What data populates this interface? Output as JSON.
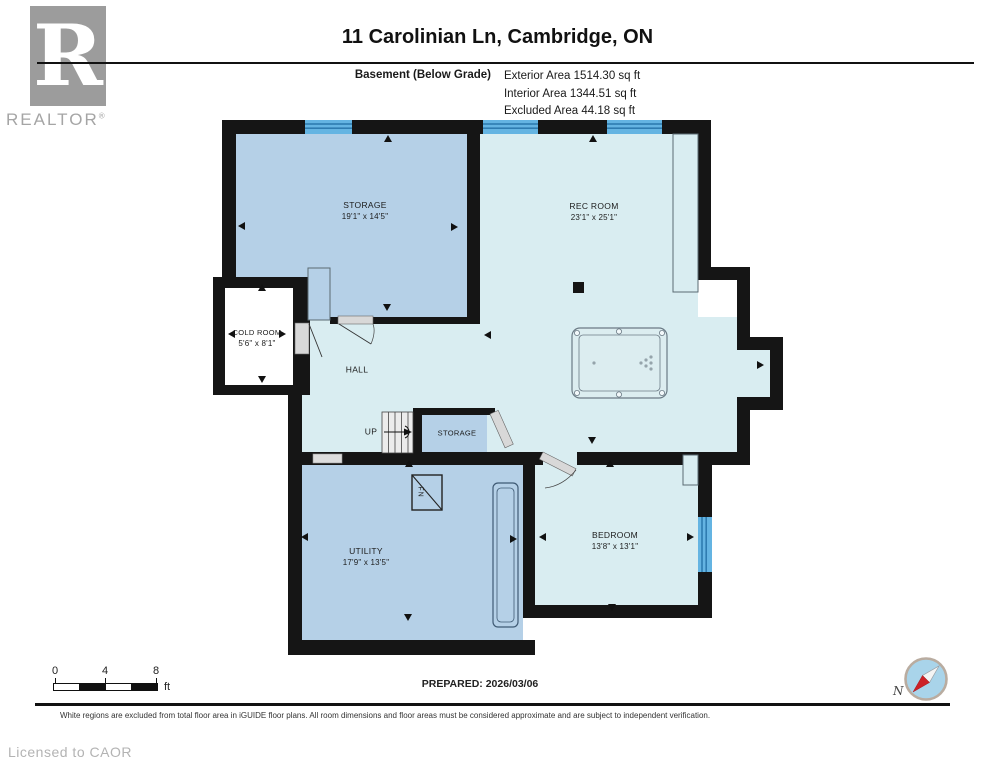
{
  "header": {
    "logo_letter": "R",
    "logo_brand": "REALTOR",
    "logo_registered": "®",
    "title": "11 Carolinian Ln, Cambridge, ON",
    "floor_label": "Basement (Below Grade)",
    "areas": [
      {
        "label": "Exterior Area",
        "value": "1514.30 sq ft"
      },
      {
        "label": "Interior Area",
        "value": "1344.51 sq ft"
      },
      {
        "label": "Excluded Area",
        "value": "44.18 sq ft"
      }
    ]
  },
  "plan": {
    "rooms": [
      {
        "id": "storage-main",
        "name": "STORAGE",
        "dims": "19'1\" x 14'5\""
      },
      {
        "id": "rec-room",
        "name": "REC ROOM",
        "dims": "23'1\" x 25'1\""
      },
      {
        "id": "cold-room",
        "name": "COLD ROOM",
        "dims": "5'6\" x 8'1\""
      },
      {
        "id": "hall",
        "name": "HALL",
        "dims": ""
      },
      {
        "id": "storage-small",
        "name": "STORAGE",
        "dims": ""
      },
      {
        "id": "utility",
        "name": "UTILITY",
        "dims": "17'9\" x 13'5\""
      },
      {
        "id": "bedroom",
        "name": "BEDROOM",
        "dims": "13'8\" x 13'1\""
      }
    ],
    "stair_label": "UP",
    "furnace_label": "FN"
  },
  "footer": {
    "scale": {
      "ticks": [
        "0",
        "4",
        "8"
      ],
      "unit": "ft"
    },
    "prepared": "PREPARED: 2026/03/06",
    "compass_label": "N",
    "disclaimer": "White regions are excluded from total floor area in iGUIDE floor plans. All room dimensions and floor areas must be considered approximate and are subject to independent verification.",
    "license": "Licensed to CAOR"
  },
  "colors": {
    "wall": "#151515",
    "room_blue": "#b5d0e7",
    "room_cyan": "#d9edf1",
    "window_blue": "#64b4e2",
    "window_stripe": "#2e7cb0",
    "door_grey": "#d8d8d8",
    "stair_grey": "#ececec",
    "logo_grey": "#9c9c9c",
    "license_grey": "#b3b3b3"
  }
}
